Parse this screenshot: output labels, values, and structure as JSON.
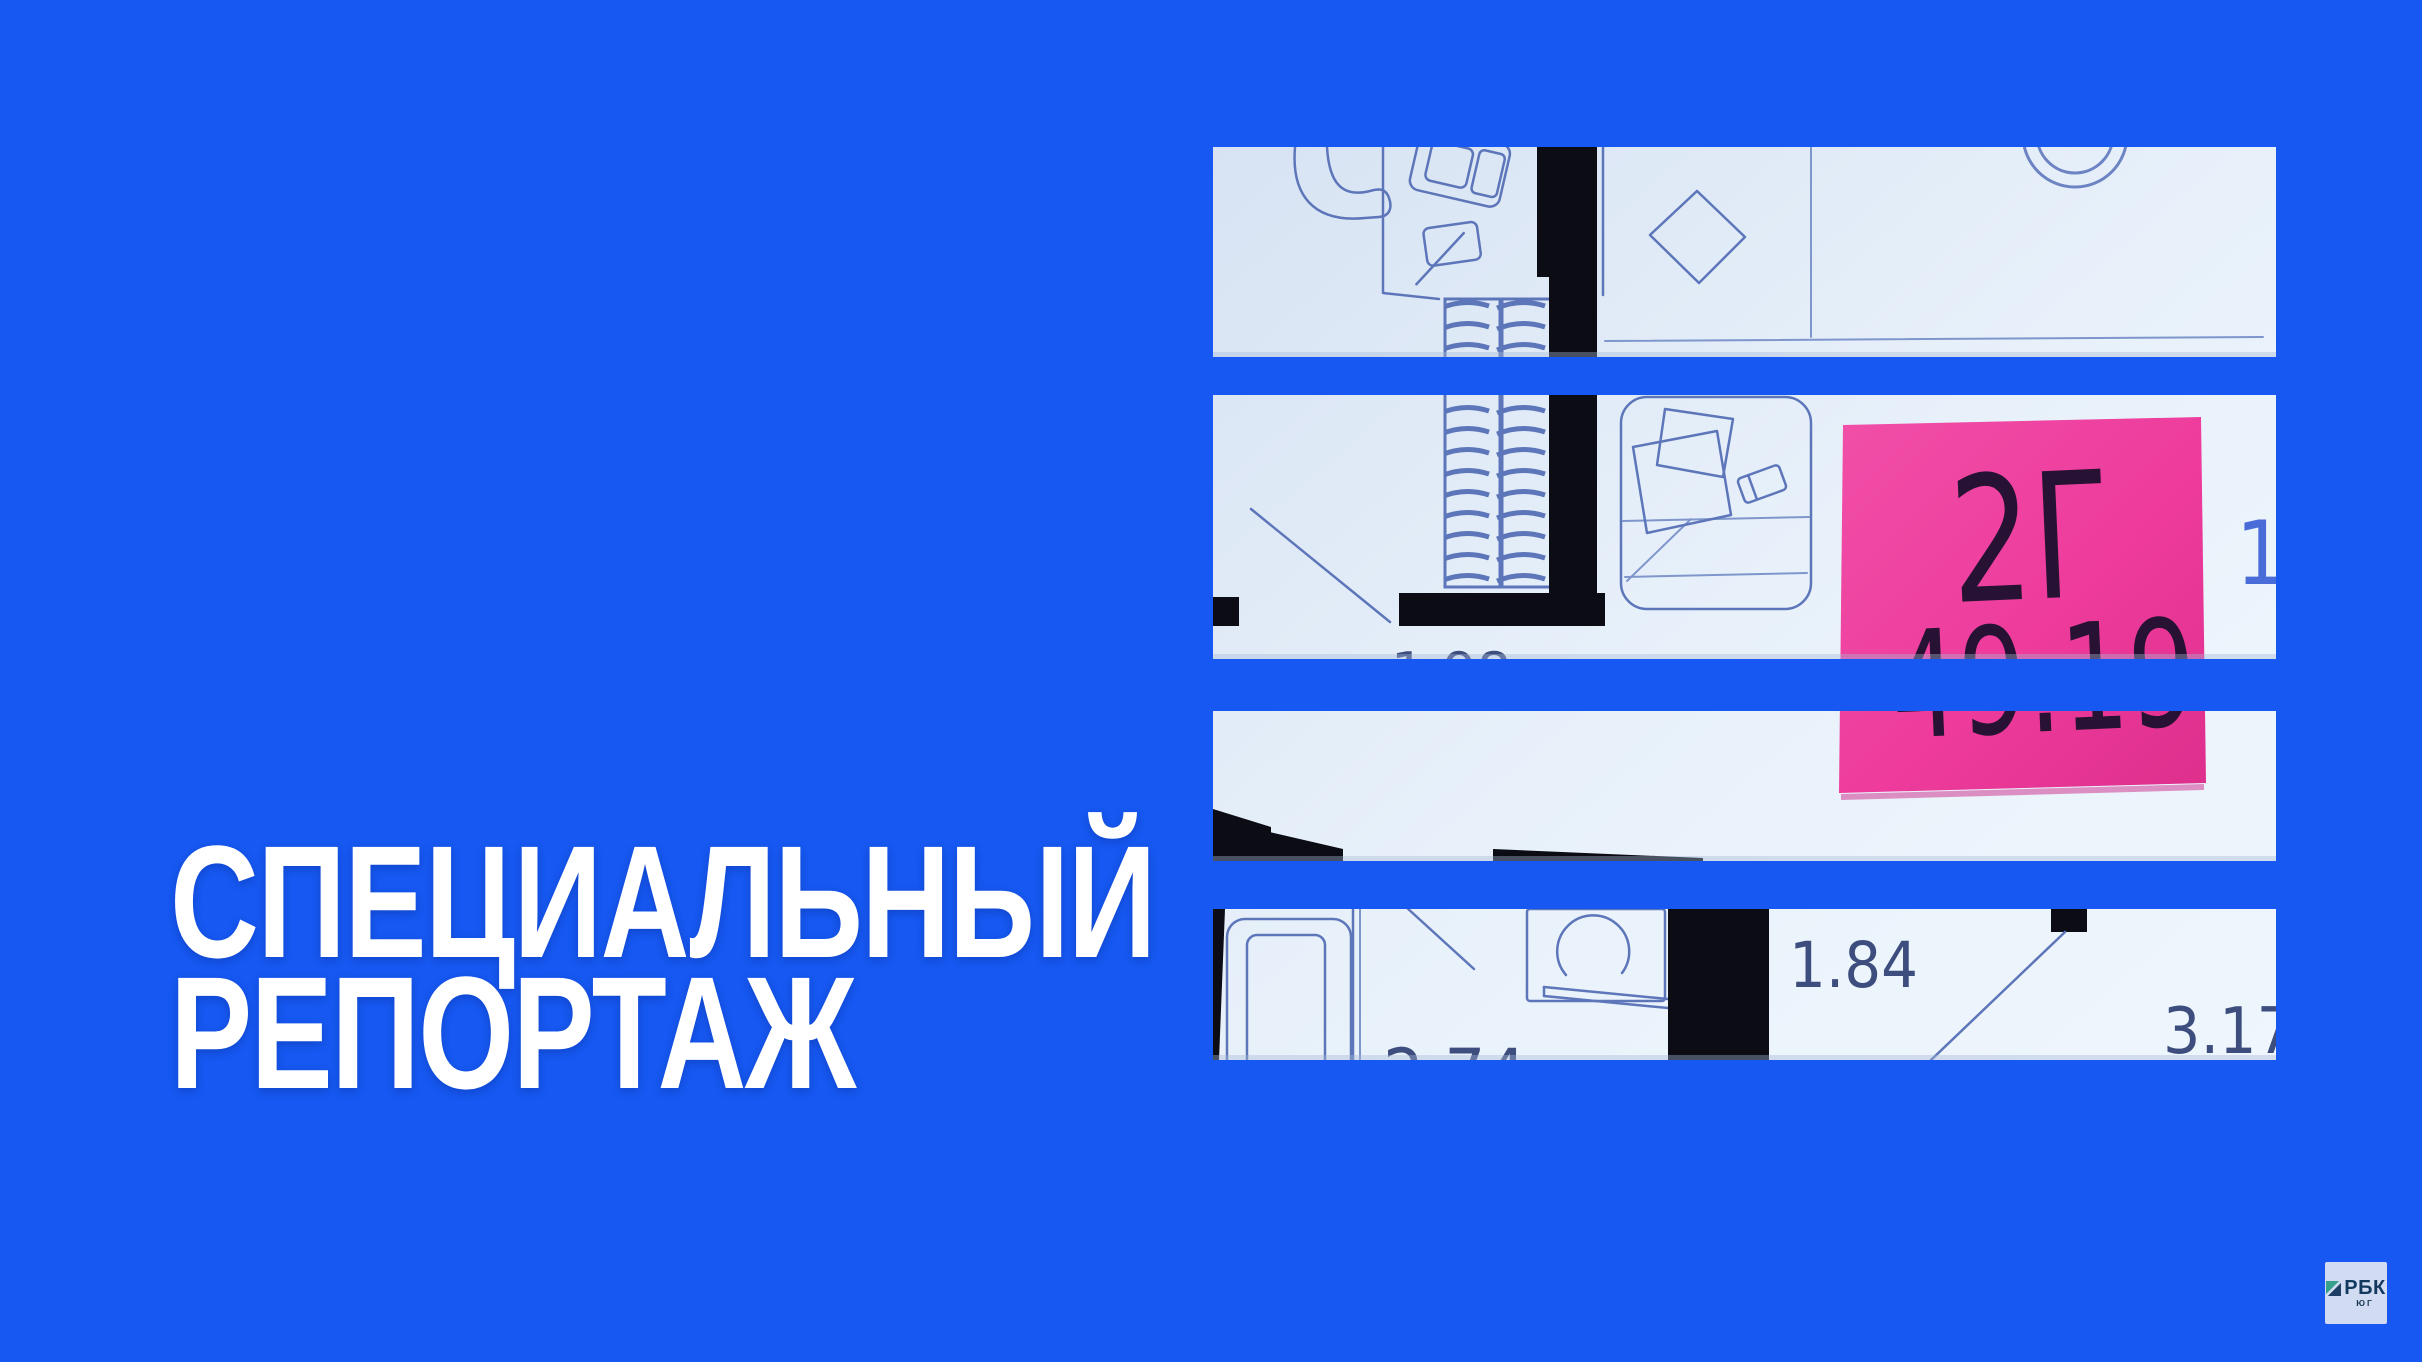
{
  "colors": {
    "background": "#1658f1",
    "highlight_pink": "#ee3b9c",
    "plan_line_blue": "#5d76ba",
    "wall_black": "#0b0c14",
    "title_white": "#ffffff"
  },
  "title": {
    "line1": "СПЕЦИАЛЬНЫЙ",
    "line2": "РЕПОРТАЖ"
  },
  "floorplan": {
    "unit": {
      "label": "2Г",
      "area": "49.19"
    },
    "dimensions": {
      "d1": "1.84",
      "d2": "3.17",
      "d3": "1.98",
      "d4": "2.74",
      "d5": "1"
    }
  },
  "logo": {
    "brand": "РБК",
    "region": "ЮГ"
  }
}
